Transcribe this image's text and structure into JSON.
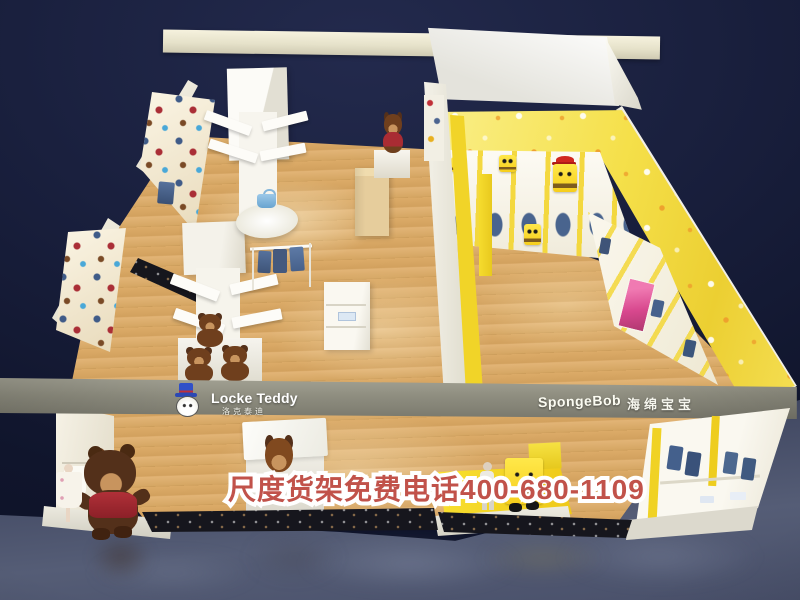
{
  "scene": {
    "colors": {
      "background_navy": "#141a33",
      "wood_floor": "#d8a964",
      "spongebob_yellow": "#f4df42",
      "signboard_gray": "#8d8d80",
      "hotline_red": "#c1524a",
      "teddy_brown": "#5a3418"
    }
  },
  "signs": {
    "locke_teddy_name": "Locke Teddy",
    "locke_teddy_cn": "洛克泰迪",
    "spongebob_name": "SpongeBob",
    "spongebob_cn": "海绵宝宝"
  },
  "overlay": {
    "hotline": "尺度货架免费电话400-680-1109"
  }
}
